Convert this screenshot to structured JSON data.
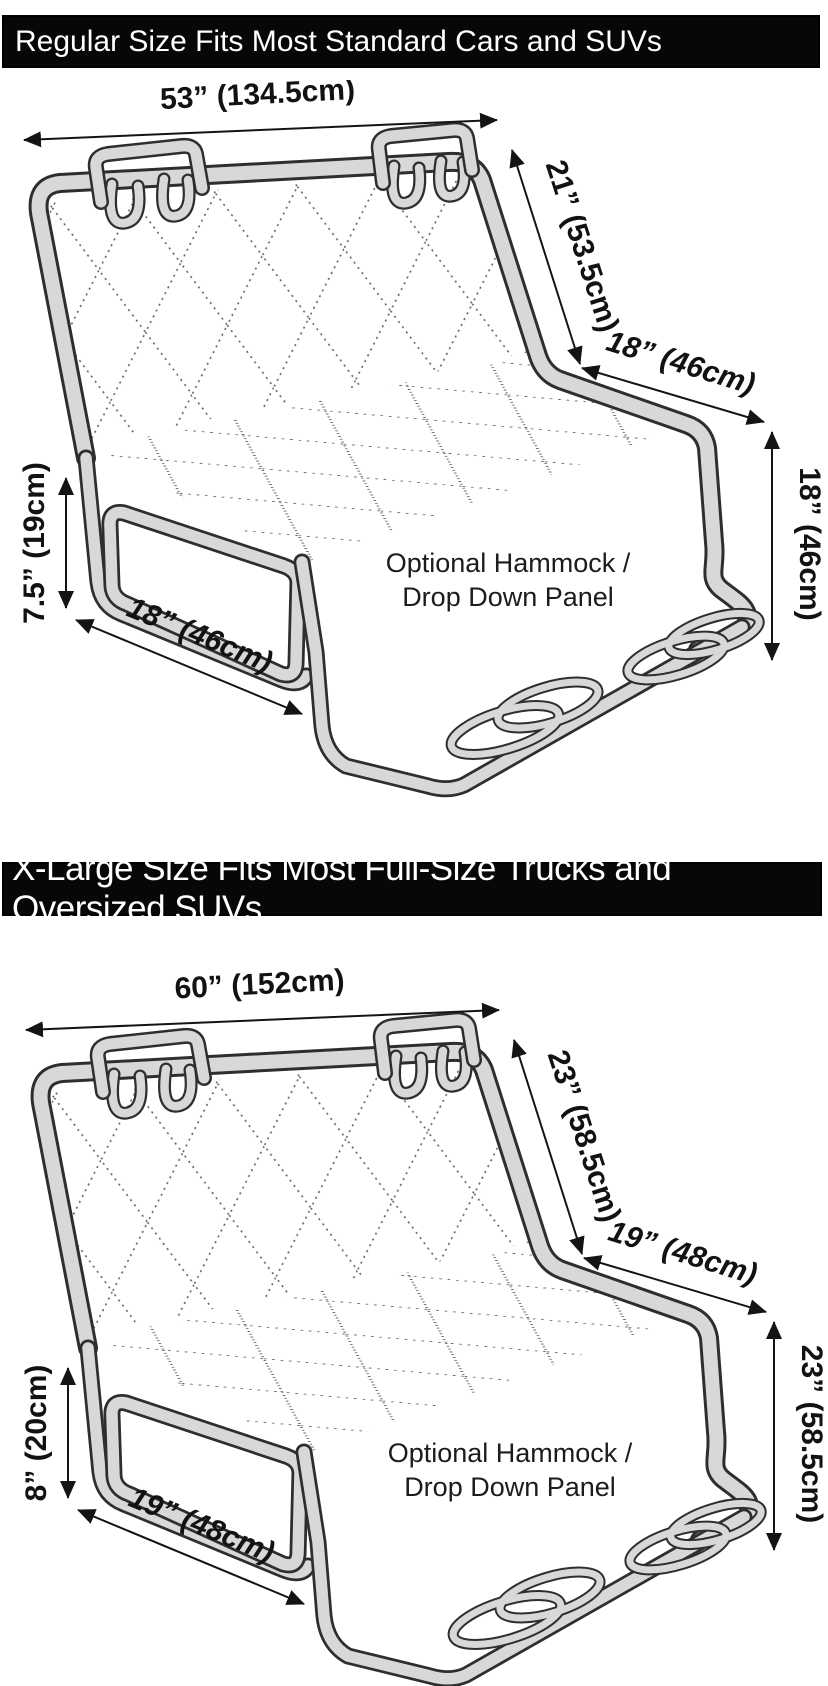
{
  "colors": {
    "header_bg": "#070707",
    "header_text": "#ffffff",
    "fabric_gray": "#d8d8d8",
    "fabric_outline": "#2e2e2e",
    "quilt_dots": "#606060",
    "dimension_ink": "#121212",
    "background": "#ffffff"
  },
  "sections": [
    {
      "id": "regular",
      "header": "Regular Size Fits Most Standard Cars and SUVs",
      "dimensions": {
        "top_width": "53” (134.5cm)",
        "backrest_height": "21” (53.5cm)",
        "seat_depth": "18” (46cm)",
        "drop_height": "18” (46cm)",
        "flap_height": "7.5” (19cm)",
        "flap_width": "18” (46cm)"
      },
      "panel_note_line1": "Optional Hammock /",
      "panel_note_line2": "Drop Down Panel"
    },
    {
      "id": "xlarge",
      "header": "X-Large Size Fits Most Full-Size Trucks and Oversized SUVs",
      "dimensions": {
        "top_width": "60” (152cm)",
        "backrest_height": "23” (58.5cm)",
        "seat_depth": "19” (48cm)",
        "drop_height": "23” (58.5cm)",
        "flap_height": "8” (20cm)",
        "flap_width": "19” (48cm)"
      },
      "panel_note_line1": "Optional Hammock /",
      "panel_note_line2": "Drop Down Panel"
    }
  ]
}
